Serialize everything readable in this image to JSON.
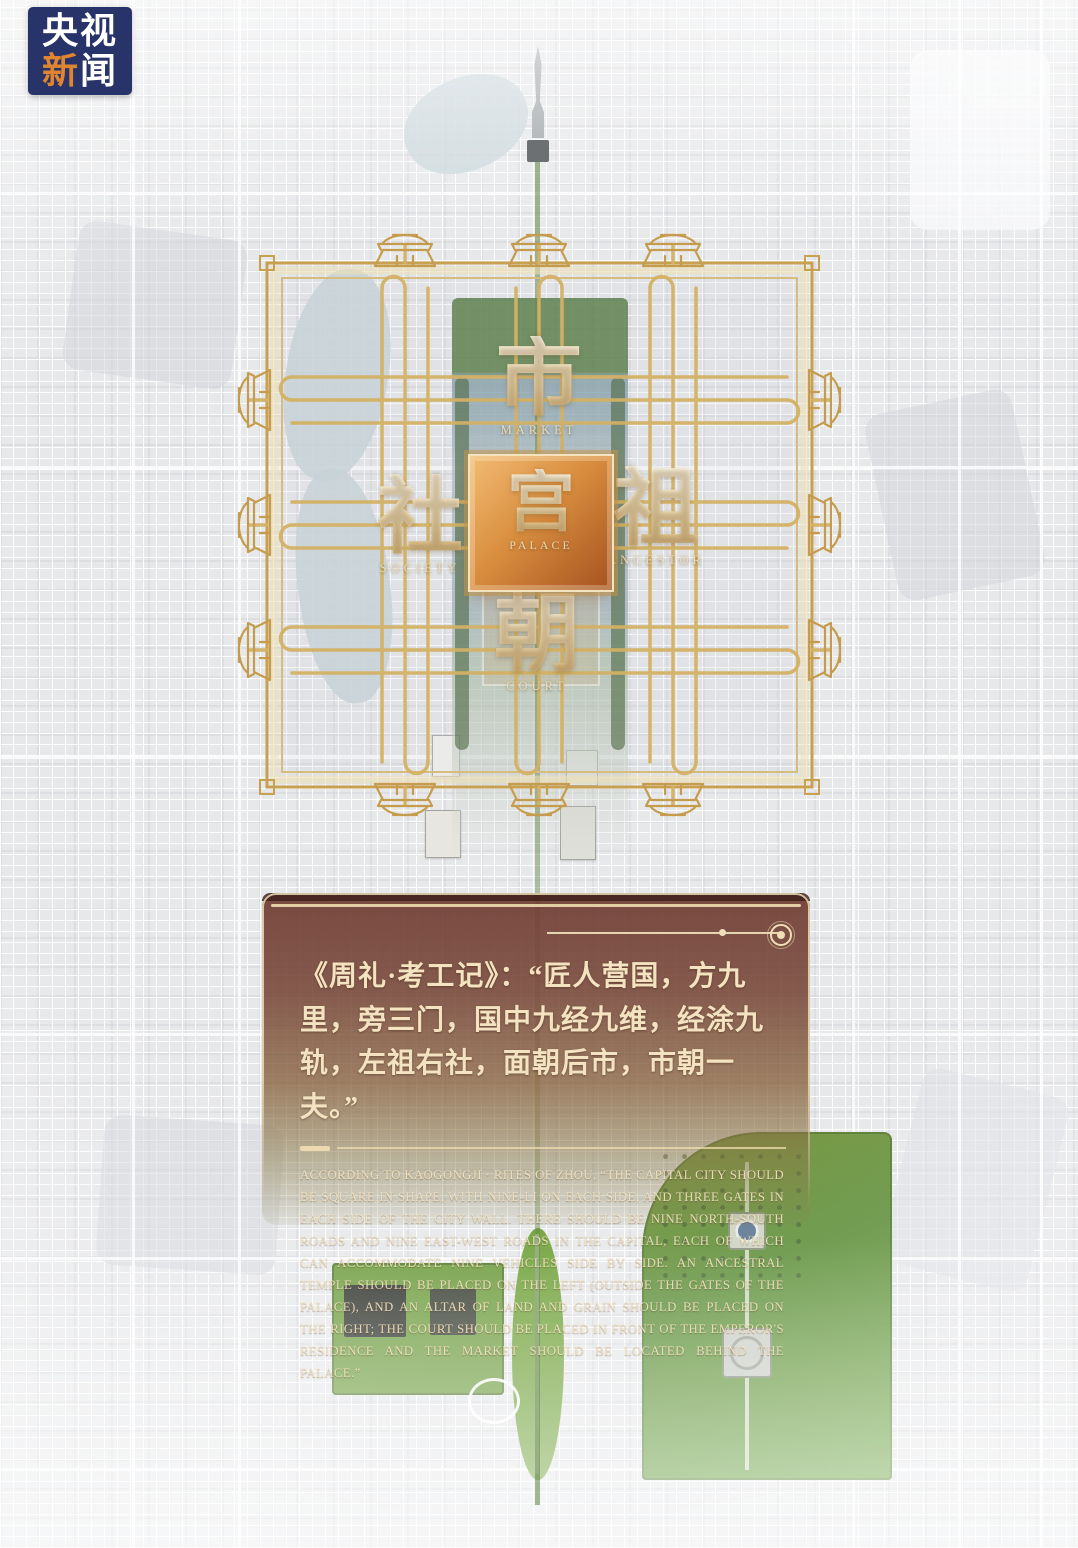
{
  "logo": {
    "line1": "央视",
    "line2a": "新",
    "line2b": "闻"
  },
  "diagram": {
    "market_zh": "市",
    "market_en": "MARKET",
    "society_zh": "社",
    "society_en": "SOCIETY",
    "palace_zh": "宫",
    "palace_en": "PALACE",
    "ancestor_zh": "祖",
    "ancestor_en": "ANCESTOR",
    "court_zh": "朝",
    "court_en": "COURT"
  },
  "panel": {
    "quote_zh": "《周礼·考工记》：“匠人营国，方九里，旁三门，国中九经九维，经涂九轨，左祖右社，面朝后市，市朝一夫。”",
    "quote_en": "ACCORDING TO KAOGONGJI · RITES OF ZHOU, “THE CAPITAL CITY SHOULD BE SQUARE IN SHAPE, WITH NINE-LI ON EACH SIDE, AND THREE GATES IN EACH SIDE OF THE CITY WALL. THERE SHOULD BE NINE NORTH-SOUTH ROADS AND NINE EAST-WEST ROADS IN THE CAPITAL, EACH OF WHICH CAN ACCOMMODATE NINE VEHICLES SIDE BY SIDE. AN ANCESTRAL TEMPLE SHOULD BE PLACED ON THE LEFT (OUTSIDE THE GATES OF THE PALACE), AND AN ALTAR OF LAND AND GRAIN SHOULD BE PLACED ON THE RIGHT; THE COURT SHOULD BE PLACED IN FRONT OF THE EMPEROR'S RESIDENCE AND THE MARKET SHOULD BE LOCATED BEHIND THE PALACE.”"
  },
  "colors": {
    "gold": "#c9a254",
    "gold_light": "#e3c98e",
    "palace_gradient_top": "#f2bc74",
    "palace_gradient_bottom": "#a4521f",
    "panel_red": "#7b4a41",
    "panel_cream": "#e8d6ac",
    "logo_navy": "#28336a",
    "logo_accent_orange": "#e0852f",
    "park_green": "#6f9d40",
    "map_gray": "#e7e8ea"
  }
}
